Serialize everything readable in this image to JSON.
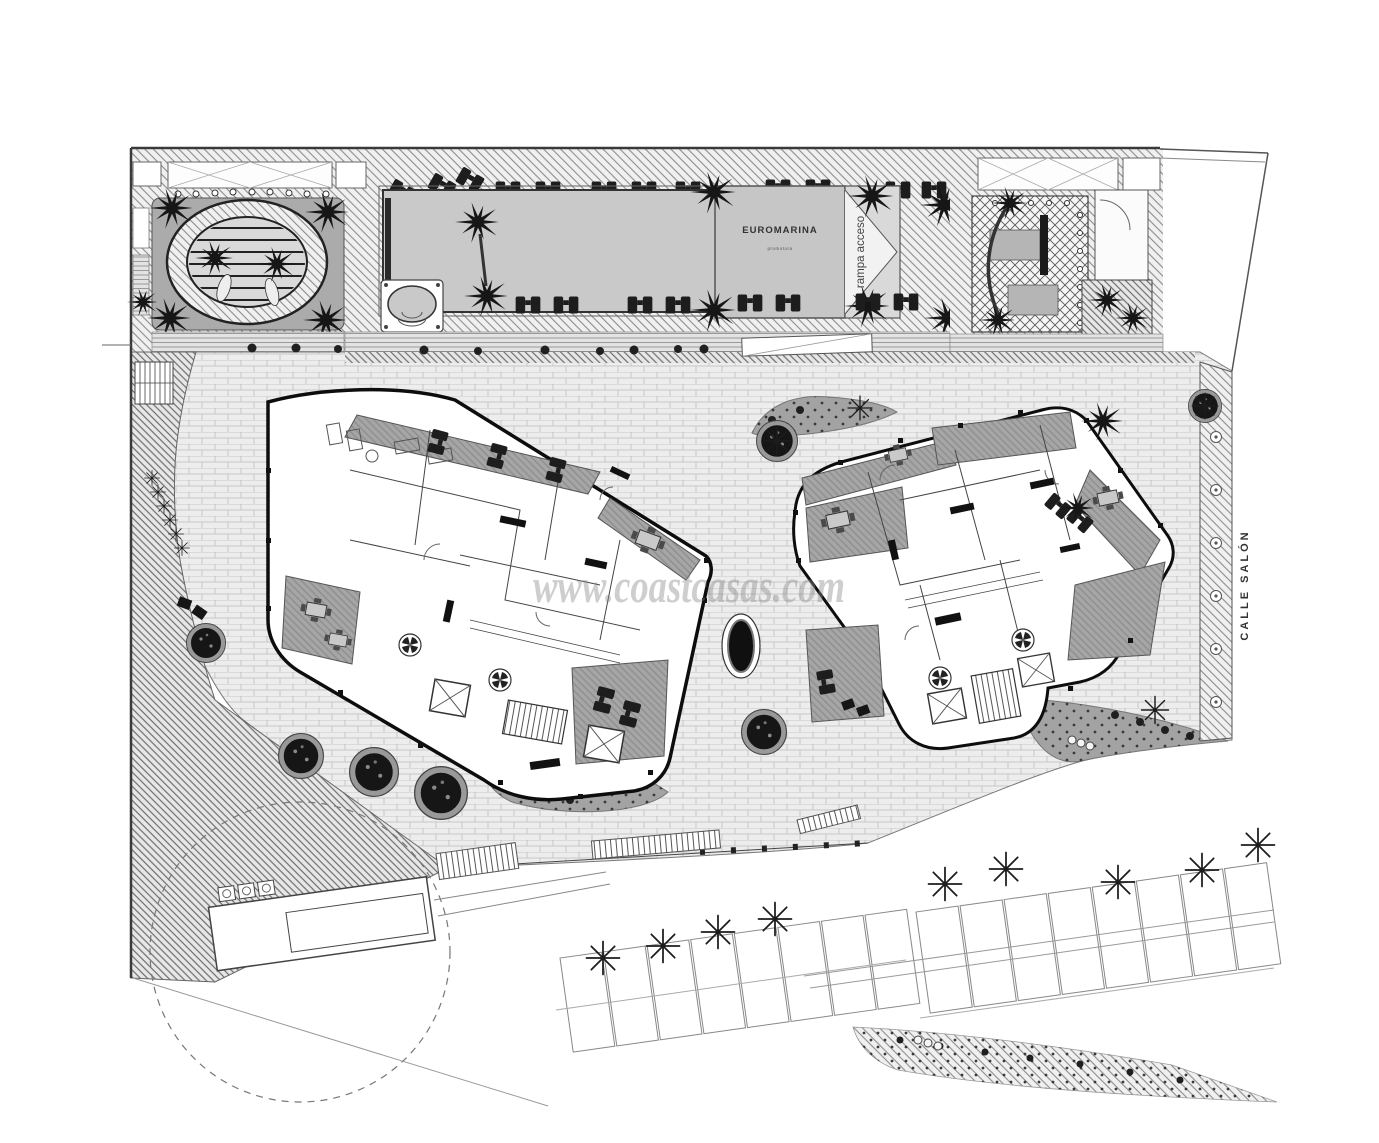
{
  "labels": {
    "pool_building": "EUROMARINA",
    "pool_building_subtitle": "promotora",
    "ramp": "rampa acceso",
    "street": "CALLE SALÓN"
  },
  "watermark": {
    "text": "www.coastcasas.com"
  },
  "palette": {
    "paper": "#ffffff",
    "ink": "#333333",
    "building_outline": "#111111",
    "terrace_gray": "#a3a3a3",
    "pool_water": "#c9c9c9",
    "panel_gray": "#ababab",
    "brick_bg": "#ededed",
    "brick_line": "#c6c6c6",
    "dark_feature": "#1a1a1a",
    "watermark_gray": "#8a8a8a"
  },
  "symbols": {
    "palm": "palm-tree-icon",
    "star_palm": "palm-asterisk-icon",
    "sunbed": "sun-lounger-icon",
    "planter": "round-planter-icon",
    "fan": "vent-fan-icon",
    "tree": "street-tree-icon",
    "table": "patio-table-icon",
    "elevator": "elevator-shaft-icon"
  }
}
